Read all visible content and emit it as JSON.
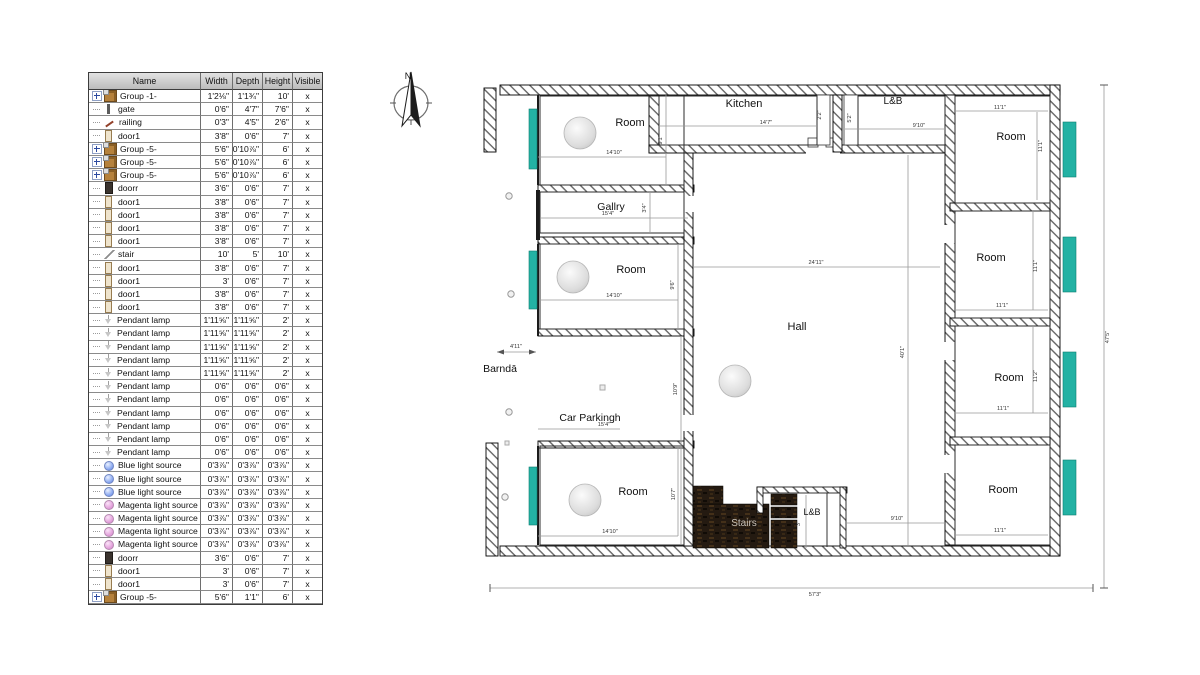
{
  "outliner": {
    "headers": [
      "Name",
      "Width",
      "Depth",
      "Height",
      "Visible"
    ],
    "rows": [
      {
        "icon": "group",
        "expand": true,
        "name": "Group -1-",
        "width": "1'2⅛\"",
        "depth": "1'1¾\"",
        "height": "10'",
        "visible": "x"
      },
      {
        "icon": "gate",
        "name": "gate",
        "width": "0'6\"",
        "depth": "4'7\"",
        "height": "7'6\"",
        "visible": "x"
      },
      {
        "icon": "railing",
        "name": "railing",
        "width": "0'3\"",
        "depth": "4'5\"",
        "height": "2'6\"",
        "visible": "x"
      },
      {
        "icon": "door1",
        "name": "door1",
        "width": "3'8\"",
        "depth": "0'6\"",
        "height": "7'",
        "visible": "x"
      },
      {
        "icon": "group",
        "expand": true,
        "name": "Group -5-",
        "width": "5'6\"",
        "depth": "0'10⅞\"",
        "height": "6'",
        "visible": "x"
      },
      {
        "icon": "group",
        "expand": true,
        "name": "Group -5-",
        "width": "5'6\"",
        "depth": "0'10⅞\"",
        "height": "6'",
        "visible": "x"
      },
      {
        "icon": "group",
        "expand": true,
        "name": "Group -5-",
        "width": "5'6\"",
        "depth": "0'10⅞\"",
        "height": "6'",
        "visible": "x"
      },
      {
        "icon": "doorr",
        "name": "doorr",
        "width": "3'6\"",
        "depth": "0'6\"",
        "height": "7'",
        "visible": "x"
      },
      {
        "icon": "door1",
        "name": "door1",
        "width": "3'8\"",
        "depth": "0'6\"",
        "height": "7'",
        "visible": "x"
      },
      {
        "icon": "door1",
        "name": "door1",
        "width": "3'8\"",
        "depth": "0'6\"",
        "height": "7'",
        "visible": "x"
      },
      {
        "icon": "door1",
        "name": "door1",
        "width": "3'8\"",
        "depth": "0'6\"",
        "height": "7'",
        "visible": "x"
      },
      {
        "icon": "door1",
        "name": "door1",
        "width": "3'8\"",
        "depth": "0'6\"",
        "height": "7'",
        "visible": "x"
      },
      {
        "icon": "stair",
        "name": "stair",
        "width": "10'",
        "depth": "5'",
        "height": "10'",
        "visible": "x"
      },
      {
        "icon": "door1",
        "name": "door1",
        "width": "3'8\"",
        "depth": "0'6\"",
        "height": "7'",
        "visible": "x"
      },
      {
        "icon": "door1",
        "name": "door1",
        "width": "3'",
        "depth": "0'6\"",
        "height": "7'",
        "visible": "x"
      },
      {
        "icon": "door1",
        "name": "door1",
        "width": "3'8\"",
        "depth": "0'6\"",
        "height": "7'",
        "visible": "x"
      },
      {
        "icon": "door1",
        "name": "door1",
        "width": "3'8\"",
        "depth": "0'6\"",
        "height": "7'",
        "visible": "x"
      },
      {
        "icon": "lamp",
        "name": "Pendant lamp",
        "width": "1'11⅝\"",
        "depth": "1'11⅝\"",
        "height": "2'",
        "visible": "x"
      },
      {
        "icon": "lamp",
        "name": "Pendant lamp",
        "width": "1'11⅝\"",
        "depth": "1'11⅝\"",
        "height": "2'",
        "visible": "x"
      },
      {
        "icon": "lamp",
        "name": "Pendant lamp",
        "width": "1'11⅝\"",
        "depth": "1'11⅝\"",
        "height": "2'",
        "visible": "x"
      },
      {
        "icon": "lamp",
        "name": "Pendant lamp",
        "width": "1'11⅝\"",
        "depth": "1'11⅝\"",
        "height": "2'",
        "visible": "x"
      },
      {
        "icon": "lamp",
        "name": "Pendant lamp",
        "width": "1'11⅝\"",
        "depth": "1'11⅝\"",
        "height": "2'",
        "visible": "x"
      },
      {
        "icon": "lamp",
        "name": "Pendant lamp",
        "width": "0'6\"",
        "depth": "0'6\"",
        "height": "0'6\"",
        "visible": "x"
      },
      {
        "icon": "lamp",
        "name": "Pendant lamp",
        "width": "0'6\"",
        "depth": "0'6\"",
        "height": "0'6\"",
        "visible": "x"
      },
      {
        "icon": "lamp",
        "name": "Pendant lamp",
        "width": "0'6\"",
        "depth": "0'6\"",
        "height": "0'6\"",
        "visible": "x"
      },
      {
        "icon": "lamp",
        "name": "Pendant lamp",
        "width": "0'6\"",
        "depth": "0'6\"",
        "height": "0'6\"",
        "visible": "x"
      },
      {
        "icon": "lamp",
        "name": "Pendant lamp",
        "width": "0'6\"",
        "depth": "0'6\"",
        "height": "0'6\"",
        "visible": "x"
      },
      {
        "icon": "lamp",
        "name": "Pendant lamp",
        "width": "0'6\"",
        "depth": "0'6\"",
        "height": "0'6\"",
        "visible": "x"
      },
      {
        "icon": "bulb-blue",
        "name": "Blue light source",
        "width": "0'3⅞\"",
        "depth": "0'3⅞\"",
        "height": "0'3⅞\"",
        "visible": "x"
      },
      {
        "icon": "bulb-blue",
        "name": "Blue light source",
        "width": "0'3⅞\"",
        "depth": "0'3⅞\"",
        "height": "0'3⅞\"",
        "visible": "x"
      },
      {
        "icon": "bulb-blue",
        "name": "Blue light source",
        "width": "0'3⅞\"",
        "depth": "0'3⅞\"",
        "height": "0'3⅞\"",
        "visible": "x"
      },
      {
        "icon": "bulb-magenta",
        "name": "Magenta light source",
        "width": "0'3⅞\"",
        "depth": "0'3⅞\"",
        "height": "0'3⅞\"",
        "visible": "x"
      },
      {
        "icon": "bulb-magenta",
        "name": "Magenta light source",
        "width": "0'3⅞\"",
        "depth": "0'3⅞\"",
        "height": "0'3⅞\"",
        "visible": "x"
      },
      {
        "icon": "bulb-magenta",
        "name": "Magenta light source",
        "width": "0'3⅞\"",
        "depth": "0'3⅞\"",
        "height": "0'3⅞\"",
        "visible": "x"
      },
      {
        "icon": "bulb-magenta",
        "name": "Magenta light source",
        "width": "0'3⅞\"",
        "depth": "0'3⅞\"",
        "height": "0'3⅞\"",
        "visible": "x"
      },
      {
        "icon": "doorr",
        "name": "doorr",
        "width": "3'6\"",
        "depth": "0'6\"",
        "height": "7'",
        "visible": "x"
      },
      {
        "icon": "door1",
        "name": "door1",
        "width": "3'",
        "depth": "0'6\"",
        "height": "7'",
        "visible": "x"
      },
      {
        "icon": "door1",
        "name": "door1",
        "width": "3'",
        "depth": "0'6\"",
        "height": "7'",
        "visible": "x"
      },
      {
        "icon": "group",
        "expand": true,
        "name": "Group -5-",
        "width": "5'6\"",
        "depth": "1'1\"",
        "height": "6'",
        "visible": "x"
      }
    ]
  },
  "plan": {
    "compass_label": "N",
    "colors": {
      "window": "#23b2a4",
      "stairs_dark": "#241a11",
      "wall_hatch": "#666666",
      "dim_text": "#333333"
    },
    "room_labels": [
      {
        "text": "Room",
        "x": 630,
        "y": 126,
        "size": 11
      },
      {
        "text": "Kitchen",
        "x": 744,
        "y": 107,
        "size": 11
      },
      {
        "text": "L&B",
        "x": 893,
        "y": 104,
        "size": 10
      },
      {
        "text": "Room",
        "x": 1011,
        "y": 140,
        "size": 11
      },
      {
        "text": "Gallry",
        "x": 611,
        "y": 210,
        "size": 10.5
      },
      {
        "text": "Room",
        "x": 631,
        "y": 273,
        "size": 11
      },
      {
        "text": "Room",
        "x": 991,
        "y": 261,
        "size": 11
      },
      {
        "text": "Hall",
        "x": 797,
        "y": 330,
        "size": 11
      },
      {
        "text": "Room",
        "x": 1009,
        "y": 381,
        "size": 11
      },
      {
        "text": "Barndā",
        "x": 500,
        "y": 372,
        "size": 10.5
      },
      {
        "text": "Car Parkingh",
        "x": 590,
        "y": 421,
        "size": 10.5
      },
      {
        "text": "Room",
        "x": 633,
        "y": 495,
        "size": 11
      },
      {
        "text": "Stairs",
        "x": 744,
        "y": 526,
        "size": 10,
        "color": "#c9c2b8"
      },
      {
        "text": "L&B",
        "x": 812,
        "y": 515,
        "size": 9
      },
      {
        "text": "Room",
        "x": 1003,
        "y": 493,
        "size": 11
      }
    ],
    "dim_labels": [
      {
        "text": "14'10\"",
        "x": 614,
        "y": 154
      },
      {
        "text": "9'1\"",
        "x": 662,
        "y": 140,
        "rot": true
      },
      {
        "text": "14'7\"",
        "x": 766,
        "y": 124
      },
      {
        "text": "2'2\"",
        "x": 821,
        "y": 115,
        "rot": true
      },
      {
        "text": "5'2\"",
        "x": 851,
        "y": 118,
        "rot": true
      },
      {
        "text": "9'10\"",
        "x": 919,
        "y": 127
      },
      {
        "text": "11'1\"",
        "x": 1000,
        "y": 109
      },
      {
        "text": "11'1\"",
        "x": 1042,
        "y": 146,
        "rot": true
      },
      {
        "text": "15'4\"",
        "x": 608,
        "y": 215
      },
      {
        "text": "3'4\"",
        "x": 646,
        "y": 208,
        "rot": true
      },
      {
        "text": "14'10\"",
        "x": 614,
        "y": 297
      },
      {
        "text": "9'6\"",
        "x": 674,
        "y": 285,
        "rot": true
      },
      {
        "text": "24'11\"",
        "x": 816,
        "y": 264
      },
      {
        "text": "11'1\"",
        "x": 1037,
        "y": 266,
        "rot": true
      },
      {
        "text": "11'1\"",
        "x": 1002,
        "y": 307
      },
      {
        "text": "40'1\"",
        "x": 904,
        "y": 352,
        "rot": true
      },
      {
        "text": "10'9\"",
        "x": 677,
        "y": 389,
        "rot": true
      },
      {
        "text": "11'2\"",
        "x": 1037,
        "y": 376,
        "rot": true
      },
      {
        "text": "11'1\"",
        "x": 1003,
        "y": 410
      },
      {
        "text": "4'11\"",
        "x": 516,
        "y": 348
      },
      {
        "text": "15'4\"",
        "x": 604,
        "y": 426
      },
      {
        "text": "10'7\"",
        "x": 675,
        "y": 494,
        "rot": true
      },
      {
        "text": "14'10\"",
        "x": 610,
        "y": 533
      },
      {
        "text": "3'",
        "x": 800,
        "y": 524,
        "rot": true
      },
      {
        "text": "9'10\"",
        "x": 897,
        "y": 520
      },
      {
        "text": "11'1\"",
        "x": 1000,
        "y": 532
      },
      {
        "text": "57'3\"",
        "x": 815,
        "y": 596
      },
      {
        "text": "47'5\"",
        "x": 1109,
        "y": 337,
        "rot": true
      }
    ]
  }
}
